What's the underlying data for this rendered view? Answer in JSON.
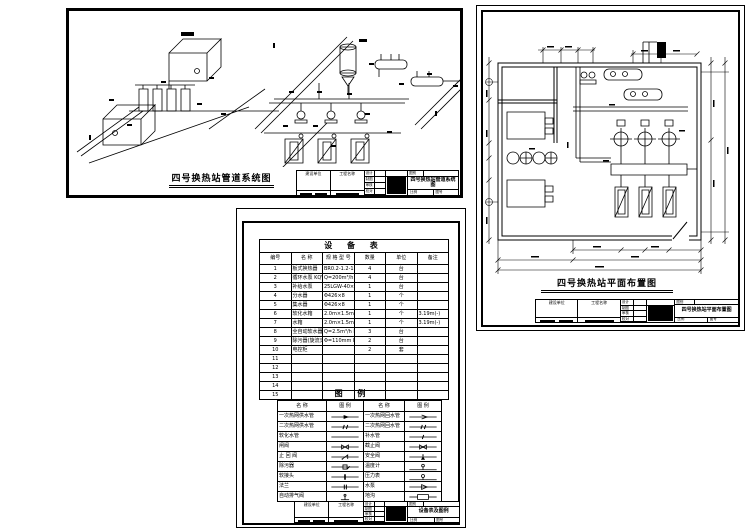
{
  "sheet_system": {
    "title": "四号换热站管道系统图"
  },
  "sheet_plan": {
    "title": "四号换热站平面布置图"
  },
  "equipment_table": {
    "title": "设  备  表",
    "headers": [
      "编号",
      "名        称",
      "规  格  型  号",
      "数量",
      "单位",
      "备注"
    ],
    "rows": [
      [
        "1",
        "板式换热器",
        "BR0.2-1.2-16-1",
        "4",
        "台",
        ""
      ],
      [
        "2",
        "循环水泵 KQW200/258-22/4-WALE",
        "Q=200m³/h  H=25.8m  N=22kW",
        "4",
        "台",
        ""
      ],
      [
        "3",
        "补给水泵",
        "25LGW-40×2",
        "1",
        "台",
        ""
      ],
      [
        "4",
        "分水器",
        "Φ426×8",
        "1",
        "个",
        ""
      ],
      [
        "5",
        "集水器",
        "Φ426×8",
        "1",
        "个",
        ""
      ],
      [
        "6",
        "软化水箱",
        "2.0m×1.5m×1.5m 钢板焊制",
        "1",
        "个",
        "3.19m(-)"
      ],
      [
        "7",
        "水箱",
        "2.0m×1.5m×1.5m 钢板焊制",
        "1",
        "个",
        "3.19m(-)"
      ],
      [
        "8",
        "全自动软水器 DXZR-160",
        "Q=2.5m³/h  DN=40mm",
        "3",
        "台",
        ""
      ],
      [
        "9",
        "除污器(旋流式) DXW-160",
        "Φ=110mm  L=500mm",
        "2",
        "台",
        ""
      ],
      [
        "10",
        "电控柜",
        "",
        "2",
        "套",
        ""
      ],
      [
        "11",
        "",
        "",
        "",
        "",
        ""
      ],
      [
        "12",
        "",
        "",
        "",
        "",
        ""
      ],
      [
        "13",
        "",
        "",
        "",
        "",
        ""
      ],
      [
        "14",
        "",
        "",
        "",
        "",
        ""
      ],
      [
        "15",
        "",
        "",
        "",
        "",
        ""
      ]
    ]
  },
  "legend": {
    "title": "图    例",
    "headers": [
      "名        称",
      "图    例",
      "名        称",
      "图    例"
    ],
    "rows": [
      {
        "ln": "一次热网供水管",
        "ls": "arrowF",
        "rn": "一次热网回水管",
        "rs": "arrowO"
      },
      {
        "ln": "二次热网供水管",
        "ls": "tick2",
        "rn": "二次热网回水管",
        "rs": "tick2"
      },
      {
        "ln": "软化水管",
        "ls": "line",
        "rn": "补水管",
        "rs": "tick1"
      },
      {
        "ln": "闸阀",
        "ls": "gate",
        "rn": "截止阀",
        "rs": "globe"
      },
      {
        "ln": "止 回 阀",
        "ls": "check",
        "rn": "安全阀",
        "rs": "relief"
      },
      {
        "ln": "除污器",
        "ls": "strainer",
        "rn": "温度计",
        "rs": "thermo"
      },
      {
        "ln": "软接头",
        "ls": "flex",
        "rn": "压力表",
        "rs": "gauge"
      },
      {
        "ln": "法兰",
        "ls": "flange",
        "rn": "水泵",
        "rs": "pump"
      },
      {
        "ln": "自动排气阀",
        "ls": "vent",
        "rn": "地沟",
        "rs": "box"
      }
    ]
  },
  "titleblock": {
    "org_label": "建设单位",
    "project_label": "工程名称",
    "row_labels": [
      "设计",
      "制图",
      "审核",
      "校对"
    ],
    "stage_label": "图别",
    "scale_label": "比例",
    "no_label": "图号",
    "system_title": "四号换热站管道系统图",
    "plan_title": "四号换热站平面布置图",
    "sheet_title": "设备表及图例"
  },
  "colors": {
    "ink": "#000000",
    "paper": "#ffffff"
  }
}
